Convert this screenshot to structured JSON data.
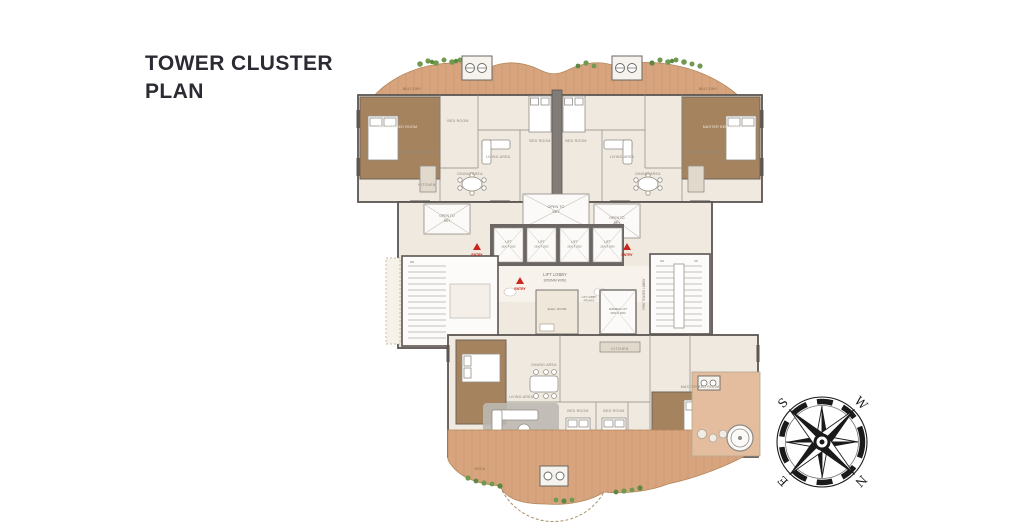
{
  "title": {
    "line1": "TOWER CLUSTER",
    "line2": "PLAN"
  },
  "plan": {
    "open_to_sky": {
      "line1": "OPEN TO",
      "line2": "SKY"
    },
    "lift": {
      "label": "LIFT",
      "size": "2600 X 2600"
    },
    "lift_lobby": {
      "line1": "LIFT LOBBY",
      "line2": "3050MM WIDE"
    },
    "entry": "ENTRY",
    "up": "UP",
    "dn": "DN",
    "firemen_lift": {
      "line1": "FIREMEN LIFT",
      "line2": "3000 X 2600"
    },
    "elec_room": "ELEC. ROOM",
    "fire_tower_lobby": "FIRE TOWER LOBBY",
    "private_lobby": {
      "line1": "LIFT LOBBY",
      "line2": "PRIVATE"
    },
    "room_labels": [
      "MASTER BED ROOM",
      "BED ROOM",
      "LIVING AREA",
      "DINING AREA",
      "KITCHEN",
      "BED ROOM",
      "BED ROOM",
      "LIVING AREA",
      "DINING AREA",
      "MASTER BED ROOM",
      "BALCONY",
      "BALCONY",
      "LIVING AREA",
      "DINING AREA",
      "KITCHEN",
      "BED ROOM",
      "BED ROOM",
      "MASTER BED ROOM",
      "DECK"
    ]
  },
  "compass": {
    "n": "N",
    "s": "S",
    "e": "E",
    "w": "W"
  },
  "colors": {
    "deck": "#d7a47d",
    "deck_light": "#e3bd9e",
    "interior": "#efe9df",
    "wood": "#a6835f",
    "wall": "#5b5652",
    "plant": "#6f9a50",
    "entry_red": "#c9271e",
    "rug": "#bdb8b3",
    "title_text": "#2b2b33"
  }
}
